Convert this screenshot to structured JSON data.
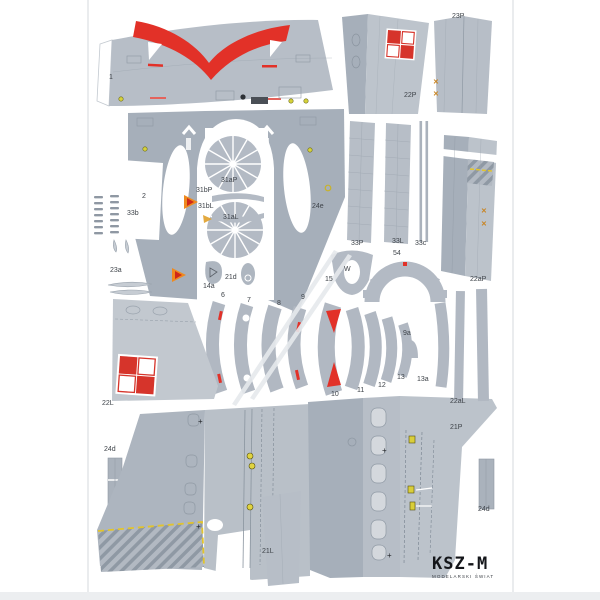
{
  "publisher": {
    "logo": "KSZ-M",
    "tagline": "MODELARSKI ŚWIAT"
  },
  "colors": {
    "part_gray": "#b7bec7",
    "part_gray_dark": "#a6afba",
    "part_gray_light": "#c5cbd2",
    "insignia_red": "#d6342b",
    "accent_red": "#e23128",
    "hatch_stroke": "#8f99a4",
    "warning_yellow": "#e2c42c",
    "mark_orange": "#c9831f"
  },
  "marks": {
    "cross": "✕",
    "plus": "+"
  },
  "part_labels": [
    "1",
    "2",
    "22P",
    "23P",
    "33b",
    "31aP",
    "31bP",
    "31bL",
    "31aL",
    "24e",
    "23a",
    "14a",
    "21d",
    "W",
    "15",
    "54",
    "33P",
    "33L",
    "33c",
    "6",
    "7",
    "8",
    "9",
    "9a",
    "10",
    "11",
    "12",
    "13",
    "13a",
    "22aP",
    "22L",
    "22aL",
    "24d",
    "21P",
    "24d",
    "21L"
  ]
}
